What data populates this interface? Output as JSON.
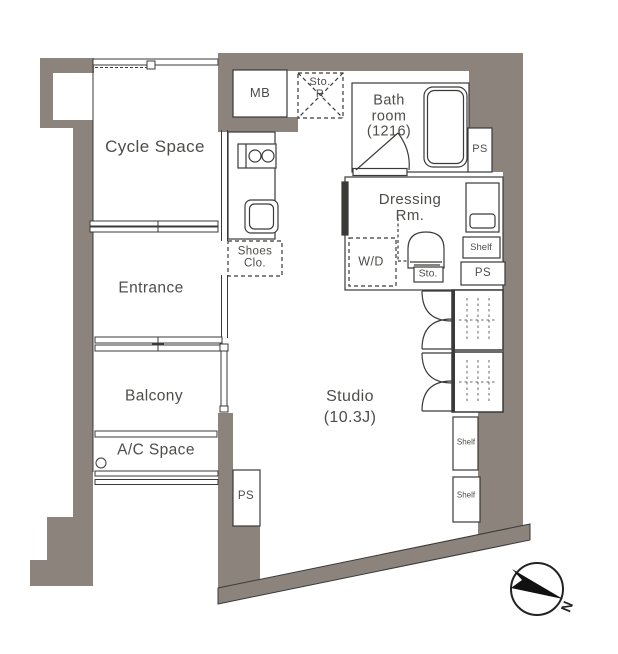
{
  "colors": {
    "wall": "#8c837d",
    "line": "#3a3a38",
    "text": "#4f4d4a"
  },
  "rooms": {
    "cycle_space": {
      "label": "Cycle Space"
    },
    "mb": {
      "label": "MB"
    },
    "sto_r": {
      "line1": "Sto.",
      "line2": "R"
    },
    "bathroom": {
      "line1": "Bath",
      "line2": "room",
      "line3": "(1216)"
    },
    "ps_top": {
      "label": "PS"
    },
    "dressing": {
      "line1": "Dressing",
      "line2": "Rm."
    },
    "shelf_upper": {
      "label": "Shelf"
    },
    "ps_right": {
      "label": "PS"
    },
    "wd": {
      "label": "W/D"
    },
    "sto": {
      "label": "Sto."
    },
    "shoes_closet": {
      "line1": "Shoes",
      "line2": "Clo."
    },
    "entrance": {
      "label": "Entrance"
    },
    "balcony": {
      "label": "Balcony"
    },
    "ac_space": {
      "label": "A/C Space"
    },
    "studio": {
      "line1": "Studio",
      "line2": "(10.3J)"
    },
    "ps_bottom": {
      "label": "PS"
    },
    "shelf_mid": {
      "label": "Shelf"
    },
    "shelf_low": {
      "label": "Shelf"
    }
  },
  "compass": {
    "label": "N"
  }
}
